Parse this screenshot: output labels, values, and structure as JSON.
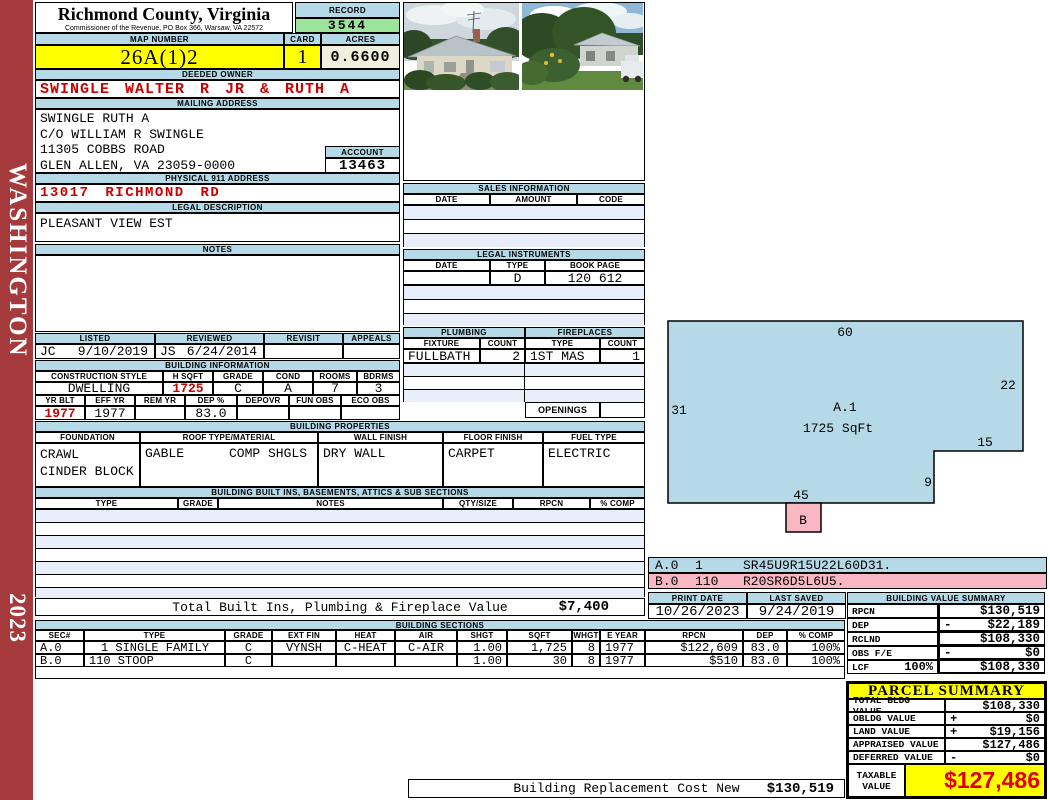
{
  "colors": {
    "band_blue": "#b5d9e6",
    "highlight_yellow": "#ffff00",
    "record_green": "#9ce49c",
    "acres_beige": "#f0eedd",
    "alert_red": "#cc0000",
    "sketch_pink": "#f9b7c3",
    "sidebar_red": "#a43a3c",
    "stripe_blue": "#e9effa"
  },
  "sidebar": {
    "district": "WASHINGTON",
    "year": "2023"
  },
  "header": {
    "county": "Richmond County, Virginia",
    "commissioner": "Commissioner of the Revenue, PO Box 366, Warsaw, VA 22572",
    "record_label": "RECORD",
    "record": "3544",
    "map_label": "MAP NUMBER",
    "map_number": "26A(1)2",
    "card_label": "CARD",
    "card": "1",
    "acres_label": "ACRES",
    "acres": "0.6600"
  },
  "owner": {
    "deeded_label": "DEEDED OWNER",
    "deeded": "SWINGLE WALTER R JR & RUTH A",
    "mailing_label": "MAILING ADDRESS",
    "mailing": [
      "SWINGLE RUTH A",
      "C/O WILLIAM R SWINGLE",
      "11305 COBBS ROAD",
      "GLEN ALLEN, VA 23059-0000"
    ],
    "account_label": "ACCOUNT",
    "account": "13463",
    "physical_label": "PHYSICAL 911 ADDRESS",
    "physical": "13017 RICHMOND RD",
    "legal_label": "LEGAL DESCRIPTION",
    "legal": "PLEASANT VIEW EST",
    "notes_label": "NOTES"
  },
  "review": {
    "listed_label": "LISTED",
    "listed_by": "JC",
    "listed_date": "9/10/2019",
    "reviewed_label": "REVIEWED",
    "reviewed_by": "JS",
    "reviewed_date": "6/24/2014",
    "revisit_label": "REVISIT",
    "appeals_label": "APPEALS"
  },
  "building_info": {
    "title": "BUILDING INFORMATION",
    "h1": [
      "CONSTRUCTION STYLE",
      "H SQFT",
      "GRADE",
      "COND",
      "ROOMS",
      "BDRMS"
    ],
    "v1": [
      "DWELLING",
      "1725",
      "C",
      "A",
      "7",
      "3"
    ],
    "h2": [
      "YR BLT",
      "EFF YR",
      "REM YR",
      "DEP %",
      "DEPOVR",
      "FUN OBS",
      "ECO OBS"
    ],
    "v2": [
      "1977",
      "1977",
      "",
      "83.0",
      "",
      "",
      ""
    ]
  },
  "building_props": {
    "title": "BUILDING PROPERTIES",
    "h": [
      "FOUNDATION",
      "ROOF TYPE/MATERIAL",
      "WALL FINISH",
      "FLOOR FINISH",
      "FUEL TYPE"
    ],
    "foundation": "CRAWL\nCINDER BLOCK",
    "roof_type": "GABLE",
    "roof_material": "COMP SHGLS",
    "wall": "DRY WALL",
    "floor": "CARPET",
    "fuel": "ELECTRIC"
  },
  "built_ins": {
    "title": "BUILDING BUILT INS, BASEMENTS, ATTICS & SUB SECTIONS",
    "h": [
      "TYPE",
      "GRADE",
      "NOTES",
      "QTY/SIZE",
      "RPCN",
      "% COMP"
    ],
    "total_label": "Total Built Ins, Plumbing & Fireplace Value",
    "total": "$7,400"
  },
  "sales": {
    "title": "SALES INFORMATION",
    "h": [
      "DATE",
      "AMOUNT",
      "CODE"
    ]
  },
  "instruments": {
    "title": "LEGAL INSTRUMENTS",
    "h": [
      "DATE",
      "TYPE",
      "BOOK PAGE"
    ],
    "type": "D",
    "book_page": "120 612"
  },
  "plumbing": {
    "title": "PLUMBING",
    "h": [
      "FIXTURE",
      "COUNT"
    ],
    "fixture": "FULLBATH",
    "count": "2"
  },
  "fireplaces": {
    "title": "FIREPLACES",
    "h": [
      "TYPE",
      "COUNT"
    ],
    "type": "1ST MAS",
    "count": "1",
    "openings_label": "OPENINGS"
  },
  "sketch": {
    "area_label": "A.1",
    "area_sqft": "1725 SqFt",
    "dim_top": "60",
    "dim_right": "22",
    "dim_left": "31",
    "dim_step_w": "15",
    "dim_step_h": "9",
    "dim_bottom": "45",
    "b_label": "B",
    "codes": [
      [
        "A.0",
        "1",
        "SR45U9R15U22L60D31."
      ],
      [
        "B.0",
        "110",
        "R20SR6D5L6U5."
      ]
    ]
  },
  "print_info": {
    "print_label": "PRINT DATE",
    "print_date": "10/26/2023",
    "saved_label": "LAST SAVED",
    "last_saved": "9/24/2019"
  },
  "value_summary": {
    "title": "BUILDING VALUE SUMMARY",
    "rows": [
      [
        "RPCN",
        "",
        "",
        "$130,519"
      ],
      [
        "DEP",
        "",
        "-",
        "$22,189"
      ],
      [
        "RCLND",
        "",
        "",
        "$108,330"
      ],
      [
        "OBS F/E",
        "",
        "-",
        "$0"
      ],
      [
        "LCF",
        "100%",
        "",
        "$108,330"
      ]
    ]
  },
  "sections_table": {
    "title": "BUILDING SECTIONS",
    "h": [
      "SEC#",
      "TYPE",
      "GRADE",
      "EXT FIN",
      "HEAT",
      "AIR",
      "SHGT",
      "SQFT",
      "WHGT",
      "E YEAR",
      "RPCN",
      "DEP",
      "% COMP"
    ],
    "rows": [
      [
        "A.0",
        "1 SINGLE FAMILY",
        "C",
        "VYNSH",
        "C-HEAT",
        "C-AIR",
        "1.00",
        "1,725",
        "8",
        "1977",
        "$122,609",
        "83.0",
        "100%"
      ],
      [
        "B.0",
        "110 STOOP",
        "C",
        "",
        "",
        "",
        "1.00",
        "30",
        "8",
        "1977",
        "$510",
        "83.0",
        "100%"
      ]
    ]
  },
  "parcel": {
    "title": "PARCEL SUMMARY",
    "rows": [
      [
        "TOTAL BLDG VALUE",
        "",
        "$108,330"
      ],
      [
        "OBLDG VALUE",
        "+",
        "$0"
      ],
      [
        "LAND VALUE",
        "+",
        "$19,156"
      ],
      [
        "APPRAISED VALUE",
        "",
        "$127,486"
      ],
      [
        "DEFERRED VALUE",
        "-",
        "$0"
      ]
    ],
    "taxable_label": "TAXABLE VALUE",
    "taxable": "$127,486"
  },
  "footer": {
    "replacement_label": "Building Replacement Cost New",
    "replacement": "$130,519"
  }
}
